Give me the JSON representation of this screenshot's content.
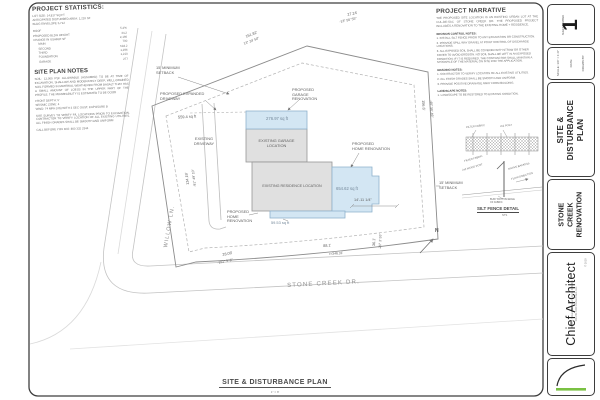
{
  "page": {
    "accent_green": "#7ac143",
    "proposed_blue": "#d3e6f3",
    "existing_gray": "#dedede"
  },
  "left_panel": {
    "stats_title": "PROJECT STATISTICS:",
    "stats_intro": "LOT SIZE: 14,817 SQ FT\nANTICIPATED DISTURBED AREA: 1,210 SF\nBLDG ENVELOPE 5,712",
    "stats_rows": [
      {
        "label": "ROOF",
        "value": "5.2%"
      },
      {
        "label": "PROPOSED BLDG HEIGHT",
        "value": "34.2"
      },
      {
        "label": "CHANGE IN USABLE SF",
        "value": "2,166"
      },
      {
        "label": "MAIN",
        "value": "700"
      },
      {
        "label": "SECOND",
        "value": "518.2"
      },
      {
        "label": "THIRD",
        "value": "1,296"
      },
      {
        "label": "FOUNDATION",
        "value": "1,210"
      },
      {
        "label": "GARAGE",
        "value": "277"
      }
    ],
    "notes_title": "SITE PLAN NOTES",
    "notes_p1": "SOIL: 12,000 PSF ALLOWABLE (ASSUMED) TO BE AT TIME OF EXCAVATION. SHALLOW AND MODERATELY DEEP, WELL-DRAINED SOIL FORMED IN MATERIAL WEATHERED FROM BASALT THAT HAS A SMALL AMOUNT OF LOESS IN THE UPPER PART OF THE PROFILE. THE PERMEABILITY IS ESTIMATED TO BE GOOD",
    "notes_p2": "FRONT DEPTH: 5'\nSEISMIC ZONE: 4\nWIND: 74 MPH (3S) WITH 3 SEC GUST, EXPOSURE B",
    "notes_p3": "SITE SURVEY TO VERIFY P/L LOCATIONS PRIOR TO EXCAVATION. CONTRACTOR TO VERIFY LOCATION OF ALL EXISTING UTILITIES. ALL FINISH GRADES SHALL BE SMOOTH AND UNIFORM",
    "notes_p4": "CALL BEFORE YOU DIG: 800 332 2344"
  },
  "narrative": {
    "title": "PROJECT NARRATIVE",
    "intro": "THE PROPOSED SITE LOCATION IS AN EXISTING URBAN LOT AT THE CUL-DE-SAC OF STONE CREEK DR. THE PROPOSED PROJECT INCLUDES A RENOVATION TO THE EXISTING HOME + RESIDENCE.",
    "erosion_heading": "EROSION CONTROL NOTES:",
    "erosion_items": [
      "1. INSTALL SILT FENCE PRIOR TO ANY EXCAVATION OR CONSTRUCTION.",
      "2. PROVIDE SPILL WAY GRAVEL AT POINT CONTROL OF DISCHARGE LOCATIONS.",
      "3. ALL EXPOSED SOIL SHALL BE COVERED WITH STRAW OR OTHER COVER TO AVOID EROSION. NO SOIL SHALL BE LEFT IN AN EXPOSED CONDITION; IF IT IS REQUIRED, THE CONTRACTOR SHALL MAINTAIN A STOCKPILE OF THE MATERIAL ON SITE FOR THE APPLICATION."
    ],
    "grading_heading": "GRADING NOTES:",
    "grading_items": [
      "1. CONTRACTOR TO VERIFY LOCATION OF ALL EXISTING UTILITIES.",
      "2. ALL FINISH GRADES SHALL BE SMOOTH AND UNIFORM.",
      "3. PROVIDE POSITIVE DRAINAGE AWAY FROM BUILDING."
    ],
    "landscape_heading": "LANDSCAPE NOTES:",
    "landscape_items": [
      "1. LANDSCAPE TO BE RESTORED TO EXISTING CONDITION."
    ]
  },
  "plan": {
    "streets": {
      "willow": "WILLOW LN.",
      "stone_creek": "STONE CREEK DR."
    },
    "labels": {
      "setback_left": "15' MINIMUM\nSETBACK",
      "setback_right": "15' MINIMUM\nSETBACK",
      "expanded_driveway": "PROPOSED EXPANDED\nDRIVEWAY",
      "garage_reno": "PROPOSED\nGARAGE\nRENOVATION",
      "home_reno_right": "PROPOSED\nHOME RENOVATION",
      "home_reno_bottom": "PROPOSED\nHOME\nRENOVATION",
      "existing_driveway": "EXISTING\nDRIVEWAY",
      "existing_garage": "EXISTING GARAGE\nLOCATION",
      "existing_residence": "EXISTING RESIDENCE LOCATION",
      "north": "N"
    },
    "areas": {
      "driveway": "559.4 sq ft",
      "garage": "276.97 sq ft",
      "home_right": "654.62 sq ft",
      "home_bottom": "59.53 sq ft"
    },
    "dims": {
      "top_left_len": "151.82'",
      "top_left_brg": "13° 24' 50\"",
      "top_right_len": "27.24'",
      "top_right_brg": "-13° 56' 55\"",
      "right_len": "156.6'",
      "right_brg": "-46° 50' 49\"",
      "bottom_len": "88.1'",
      "bottom_radius": "r=346.31'",
      "corner_len": "28.08'",
      "corner_brg": "-151° 5' 8\"",
      "left_len": "134.19'",
      "left_brg": "-91° 49' 10\"",
      "lower_right_len": "36.1'",
      "lower_right_brg": "-26° 3' 55\"",
      "addition_width": "14'-11 1/4\""
    },
    "detail": {
      "caption": "SILT FENCE DETAIL",
      "scale": "NTS",
      "post_label": "2x2 POST",
      "fabric_label": "FILTER FABRIC",
      "wood_post": "2x2 WOOD POST",
      "filter_fabric": "FILTER FABRIC",
      "native_backfill": "NATIVE BACKFILL",
      "flow_direction": "FLOW DIRECTION",
      "bury_note": "BURY BOTTOM EDGE\nOF FABRIC"
    },
    "caption": {
      "title": "SITE & DISTURBANCE PLAN",
      "scale": "1\" = 8'"
    }
  },
  "title_block": {
    "sheet_number_label": "SHEET NUMBER",
    "sheet_number": "1",
    "scale_line": "SCALE: 1/4\" = 1'-0\"",
    "date_line": "DATE:",
    "drawn_by_line": "DRAWN BY:",
    "sheet_title": "SITE & DISTURBANCE\nPLAN",
    "project_title": "STONE CREEK\nRENOVATION",
    "brand": "Chief Architect",
    "copyright": "© 2019",
    "address_line1": "6500 N. Mineral Dr.  Coeur d'Alene, ID 83815",
    "address_line2": "208.292.3400   chiefarchitect.com"
  }
}
